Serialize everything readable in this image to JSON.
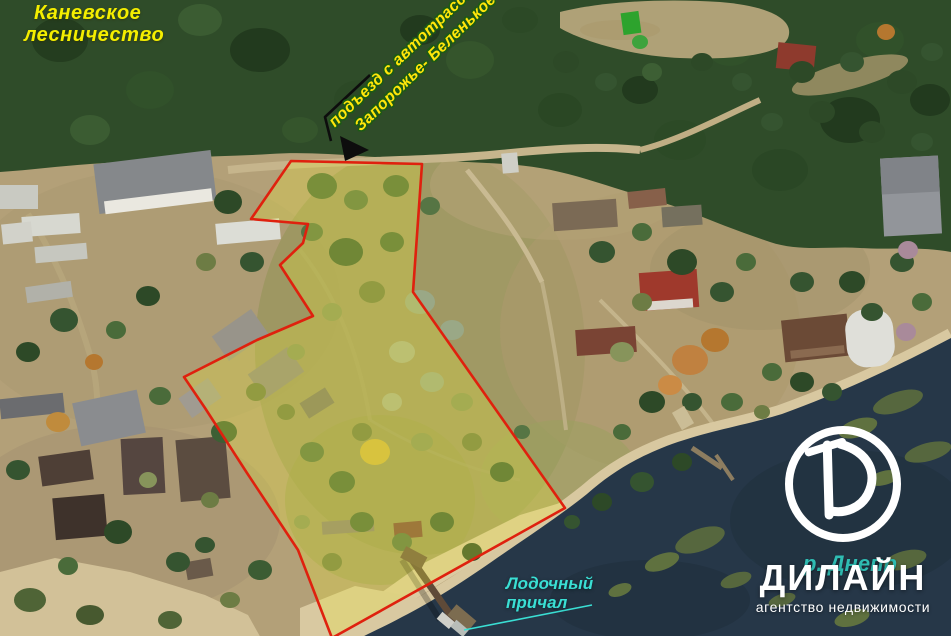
{
  "labels": {
    "forestry": {
      "line1": "Каневское",
      "line2": "лесничество"
    },
    "access_road": {
      "line1": "подъезд с автотрассы",
      "line2": "Запорожье- Беленькое"
    },
    "boat_dock": {
      "line1": "Лодочный",
      "line2": "причал"
    },
    "river": "р. Днепр"
  },
  "brand": {
    "logo_letter": "D",
    "name": "ДИЛАЙН",
    "tagline": "агентство недвижимости"
  },
  "colors": {
    "annotation_red": "#df210e",
    "property_highlight": "#e9e33a",
    "forestry_yellow": "#f4ee00",
    "access_text_yellow": "#ffe60a",
    "access_text_outline": "#1c5a14",
    "dock_cyan": "#3adfd4",
    "river_teal": "#2fbdb3",
    "brand_white": "#ffffff",
    "water": "#263748",
    "forest_green": "#2f4c29",
    "terrain_tan": "#b3a078",
    "arrow_black": "#0d0d0d"
  }
}
